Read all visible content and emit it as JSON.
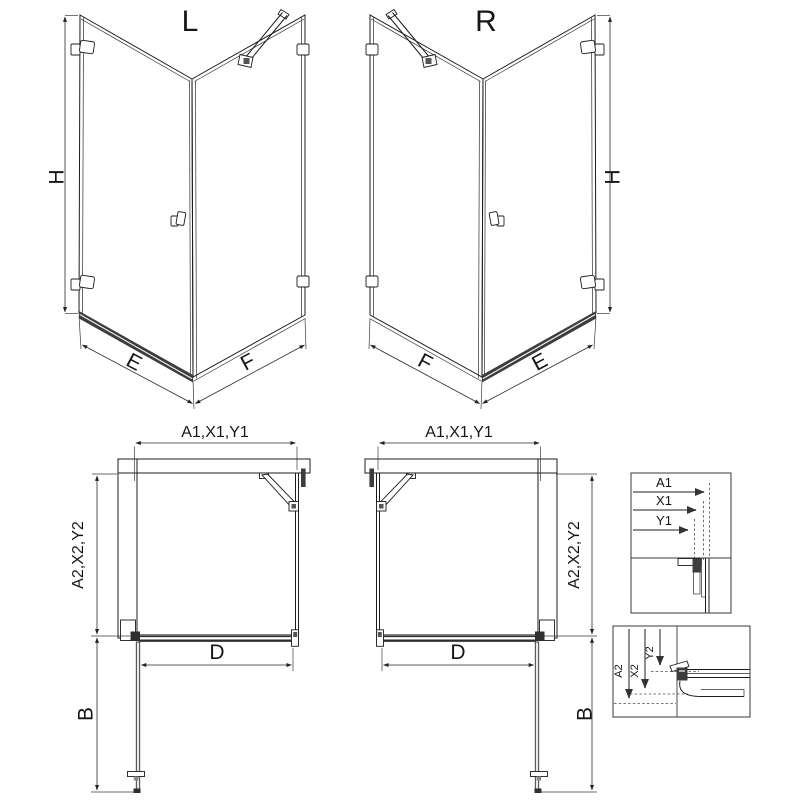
{
  "views": {
    "iso_left": {
      "label": "L",
      "dim_height": "H",
      "dim_bottom_left": "E",
      "dim_bottom_right": "F"
    },
    "iso_right": {
      "label": "R",
      "dim_height": "H",
      "dim_bottom_left": "F",
      "dim_bottom_right": "E"
    },
    "plan_left": {
      "dim_top": "A1,X1,Y1",
      "dim_side": "A2,X2,Y2",
      "dim_door": "D",
      "dim_swing": "B"
    },
    "plan_right": {
      "dim_top": "A1,X1,Y1",
      "dim_side": "A2,X2,Y2",
      "dim_door": "D",
      "dim_swing": "B"
    },
    "detail_top": {
      "dims": [
        "A1",
        "X1",
        "Y1"
      ]
    },
    "detail_bottom": {
      "dims": [
        "A2",
        "X2",
        "Y2"
      ]
    }
  },
  "colors": {
    "background": "#ffffff",
    "line": "#1c1c1c",
    "dimension_line": "#2a2a2a",
    "hatch": "#4a4a4a",
    "threshold": "#3d3d3d",
    "detail_arrow": "#8f8f8f"
  }
}
